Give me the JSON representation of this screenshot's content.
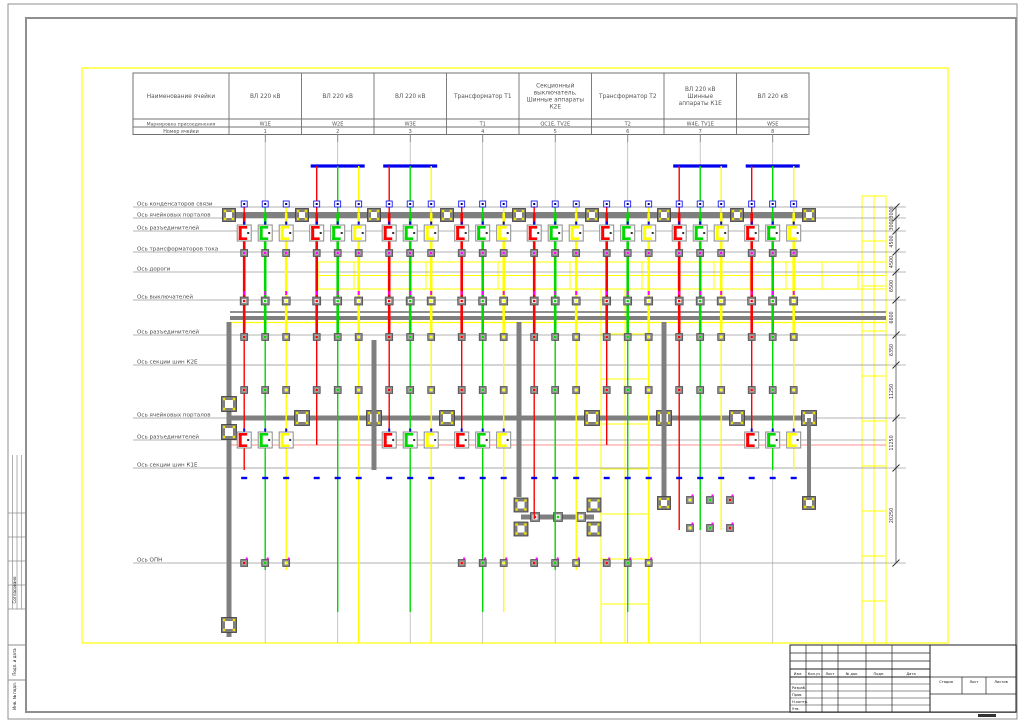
{
  "sheet": {
    "width": 1024,
    "height": 723,
    "bg": "#ffffff",
    "frame_color": "#8f8f8f",
    "drawing_border_color": "#ffff00"
  },
  "binding_strip": {
    "labels": [
      {
        "text": "Согласовано",
        "y": 590
      },
      {
        "text": "Подп. и дата",
        "y": 662
      },
      {
        "text": "Инв. № подл.",
        "y": 696
      }
    ]
  },
  "header_table": {
    "x": 133,
    "right": 809,
    "name_col_right": 229,
    "top": 73,
    "r1": 119,
    "r2": 127,
    "bottom": 134.5,
    "name_header": "Наименование ячейки",
    "marking_label": "Маркировка присоединения",
    "number_label": "Номер ячейки",
    "bays": [
      {
        "name_lines": [
          "ВЛ 220 кВ"
        ],
        "marking": "W1E",
        "number": "1"
      },
      {
        "name_lines": [
          "ВЛ 220 кВ"
        ],
        "marking": "W2E",
        "number": "2"
      },
      {
        "name_lines": [
          "ВЛ 220 кВ"
        ],
        "marking": "W3E",
        "number": "3"
      },
      {
        "name_lines": [
          "Трансформатор Т1"
        ],
        "marking": "Т1",
        "number": "4"
      },
      {
        "name_lines": [
          "Секционный",
          "выключатель,",
          "Шинные аппараты",
          "К2Е"
        ],
        "marking": "QC1E, TV2E",
        "number": "5"
      },
      {
        "name_lines": [
          "Трансформатор Т2"
        ],
        "marking": "Т2",
        "number": "6"
      },
      {
        "name_lines": [
          "ВЛ 220 кВ",
          "Шинные",
          "аппараты К1Е"
        ],
        "marking": "W4E, TV1E",
        "number": "7"
      },
      {
        "name_lines": [
          "ВЛ 220 кВ"
        ],
        "marking": "W5E",
        "number": "8"
      }
    ]
  },
  "axes": [
    {
      "label": "Ось конденсаторов связи",
      "y": 207
    },
    {
      "label": "Ось ячейковых порталов",
      "y": 218
    },
    {
      "label": "Ось разъединителей",
      "y": 231
    },
    {
      "label": "Ось трансформаторов тока",
      "y": 252
    },
    {
      "label": "Ось дороги",
      "y": 272
    },
    {
      "label": "Ось выключателей",
      "y": 300
    },
    {
      "label": "Ось разъединителей",
      "y": 335
    },
    {
      "label": "Ось секции шин К2Е",
      "y": 365
    },
    {
      "label": "Ось ячейковых порталов",
      "y": 418
    },
    {
      "label": "Ось разъединителей",
      "y": 440
    },
    {
      "label": "Ось секции шин К1Е",
      "y": 468
    },
    {
      "label": "Ось ОПН",
      "y": 563
    }
  ],
  "dimensions": {
    "line_x": 896,
    "tick_ys": [
      207,
      218,
      231,
      252,
      272,
      300,
      335,
      365,
      418,
      468,
      563
    ],
    "values": [
      "3000",
      "3000",
      "4500",
      "4500",
      "6500",
      "6600",
      "6350",
      "11250",
      "11250",
      "20250"
    ]
  },
  "colors": {
    "phase_a": "#ff0000",
    "phase_b": "#00d800",
    "phase_c": "#ffff00",
    "structure": "#7f7f7f",
    "gantry": "#0000ee",
    "road": "#ffff00",
    "magenta": "#ff00ff",
    "blue": "#0000ee",
    "axis_line": "#9a9a9a",
    "text": "#4a4a4a"
  },
  "plan": {
    "bay_centers": [
      265.2,
      337.7,
      410.2,
      482.7,
      555.2,
      627.7,
      700.2,
      772.7
    ],
    "phase_offset": 21,
    "bays": [
      {
        "gantry": false,
        "top": 204,
        "ends": [
          470,
          570,
          570
        ],
        "disc3": true,
        "opn": true
      },
      {
        "gantry": true,
        "top": 166,
        "ends": [
          445,
          612,
          643
        ],
        "disc3": false,
        "opn": false
      },
      {
        "gantry": true,
        "top": 166,
        "ends": [
          445,
          612,
          643
        ],
        "disc3": true,
        "opn": false
      },
      {
        "gantry": false,
        "top": 204,
        "ends": [
          445,
          612,
          612
        ],
        "disc3": true,
        "opn": true
      },
      {
        "gantry": false,
        "top": 204,
        "ends": [
          519,
          570,
          570
        ],
        "disc3": false,
        "opn": true
      },
      {
        "gantry": false,
        "top": 204,
        "ends": [
          445,
          612,
          643
        ],
        "disc3": false,
        "opn": true
      },
      {
        "gantry": true,
        "top": 166,
        "ends": [
          530,
          530,
          530
        ],
        "disc3": false,
        "opn": false
      },
      {
        "gantry": true,
        "top": 166,
        "ends": [
          445,
          470,
          470
        ],
        "disc3": true,
        "opn": false
      }
    ],
    "rows": {
      "capacitor_y": 204,
      "portal1_y": 215,
      "disc1_y": 233,
      "ct_y": 253,
      "breaker_y": 301,
      "disc2_y": 337,
      "disc2b_y": 390,
      "disc3_y": 440,
      "opn_y": 563,
      "blue_dash_y": 478
    },
    "roads": [
      {
        "x1": 318,
        "y1": 262,
        "x2": 886,
        "y2": 289,
        "step": 36
      },
      {
        "x1": 601,
        "y1": 289,
        "x2": 649,
        "y2": 643,
        "step": 45
      },
      {
        "x1": 862,
        "y1": 196,
        "x2": 886,
        "y2": 643,
        "step": 45
      }
    ],
    "buses": [
      {
        "y": 312,
        "x1": 230,
        "x2": 886,
        "color": "#8f8f8f",
        "w": 2
      },
      {
        "y": 318,
        "x1": 230,
        "x2": 886,
        "color": "#7f7f7f",
        "w": 4
      },
      {
        "y": 322.5,
        "x1": 230,
        "x2": 886,
        "color": "#ffff00",
        "w": 1.2
      },
      {
        "y": 365,
        "x1": 230,
        "x2": 886,
        "color": "#a8a8a8",
        "w": 1
      },
      {
        "y": 445,
        "x1": 230,
        "x2": 886,
        "color": "#ff9090",
        "w": 1
      },
      {
        "y": 468,
        "x1": 230,
        "x2": 886,
        "color": "#a8a8a8",
        "w": 1
      }
    ],
    "portals": [
      {
        "type": "h",
        "y": 215,
        "x1": 230,
        "x2": 812,
        "w": 6,
        "f": [
          229,
          302,
          374,
          447,
          519,
          592,
          664,
          737,
          809
        ],
        "fs": 13
      },
      {
        "type": "h",
        "y": 418,
        "x1": 230,
        "x2": 812,
        "w": 5,
        "f": [
          302,
          374,
          447,
          592,
          664,
          737,
          809
        ],
        "fs": 15
      },
      {
        "type": "h",
        "y": 517,
        "x1": 521,
        "x2": 594,
        "w": 5,
        "f": [],
        "fs": 14
      },
      {
        "type": "v",
        "x": 229,
        "y1": 322,
        "y2": 637,
        "w": 5,
        "f": [
          404,
          432,
          625
        ],
        "fs": 15
      },
      {
        "type": "v",
        "x": 374,
        "y1": 340,
        "y2": 470,
        "w": 5,
        "f": [],
        "fs": 13
      },
      {
        "type": "v",
        "x": 519,
        "y1": 322,
        "y2": 497,
        "w": 5,
        "f": [],
        "fs": 13
      },
      {
        "type": "v",
        "x": 664,
        "y1": 322,
        "y2": 505,
        "w": 5,
        "f": [
          503
        ],
        "fs": 13
      },
      {
        "type": "v",
        "x": 809,
        "y1": 418,
        "y2": 500,
        "w": 4,
        "f": [
          503
        ],
        "fs": 13
      }
    ],
    "extra_footings": [
      [
        521,
        505
      ],
      [
        521,
        529
      ],
      [
        594,
        505
      ],
      [
        594,
        529
      ]
    ],
    "disc_h": [
      [
        535,
        517,
        "#ff0000"
      ],
      [
        558,
        517,
        "#00d800"
      ],
      [
        581,
        517,
        "#ffff00"
      ]
    ],
    "box_clusters": [
      {
        "xs": [
          690,
          710,
          730
        ],
        "ys": [
          500,
          528
        ]
      }
    ]
  },
  "title_block": {
    "x": 790,
    "y": 645,
    "right": 1016,
    "bottom": 712,
    "split_x": 930,
    "rev_row_ys": [
      653,
      661
    ],
    "header_row_y": 669,
    "header_row_bottom": 677,
    "col_xs": [
      806,
      822,
      838,
      866,
      892
    ],
    "header_cols": [
      {
        "label": "Изм.",
        "x": 798
      },
      {
        "label": "Кол.уч",
        "x": 814
      },
      {
        "label": "Лист",
        "x": 830
      },
      {
        "label": "№ док.",
        "x": 852
      },
      {
        "label": "Подп.",
        "x": 879
      },
      {
        "label": "Дата",
        "x": 911
      }
    ],
    "row_ys": [
      684,
      691,
      698,
      705
    ],
    "row_labels": [
      "Разраб.",
      "Пров.",
      "Н.контр.",
      "Утв."
    ],
    "stage": {
      "labels": [
        "Стадия",
        "Лист",
        "Листов"
      ],
      "xs": [
        946,
        974,
        1001
      ],
      "col_xs": [
        962,
        986
      ],
      "top": 677,
      "mid": 694
    }
  }
}
